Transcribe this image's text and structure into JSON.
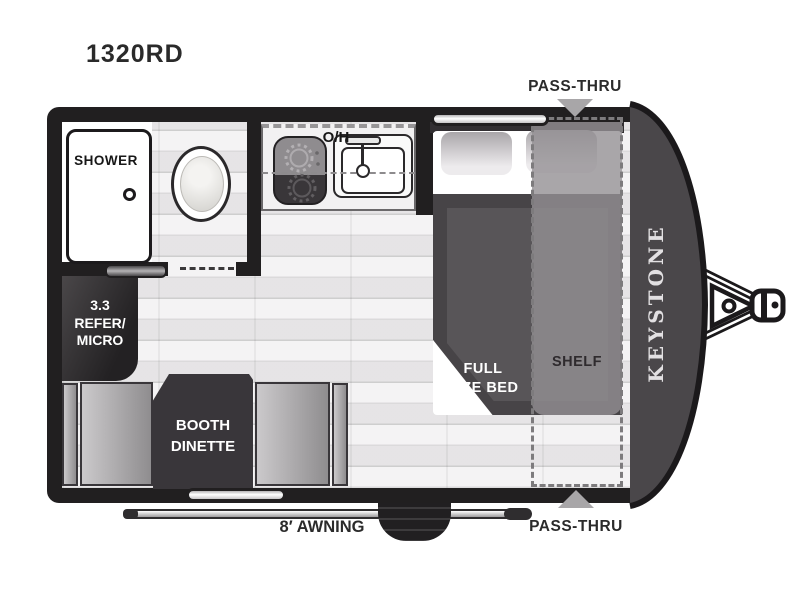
{
  "model": "1320RD",
  "brand": "KEYSTONE",
  "labels": {
    "pass_thru_top": "PASS-THRU",
    "pass_thru_bottom": "PASS-THRU",
    "awning": "8′ AWNING",
    "overhead_cabinet": "O/H",
    "shower": "SHOWER",
    "shelf": "SHELF",
    "bed_line1": "FULL",
    "bed_line2": "SIZE BED",
    "refer_line1": "3.3",
    "refer_line2": "REFER/",
    "refer_line3": "MICRO",
    "dinette_line1": "BOOTH",
    "dinette_line2": "DINETTE"
  },
  "colors": {
    "wall": "#211f20",
    "nose": "#4a474a",
    "floor": "#ebeaeb",
    "bed_blanket": "#474447",
    "bed_blanket_inner": "#585558",
    "shelf_overlay": "#949093",
    "furniture_dark": "#39363a",
    "arrow_gray": "#a8a6a8",
    "text_dark": "#2b2b2b",
    "brand_text": "#e2e0e2"
  }
}
